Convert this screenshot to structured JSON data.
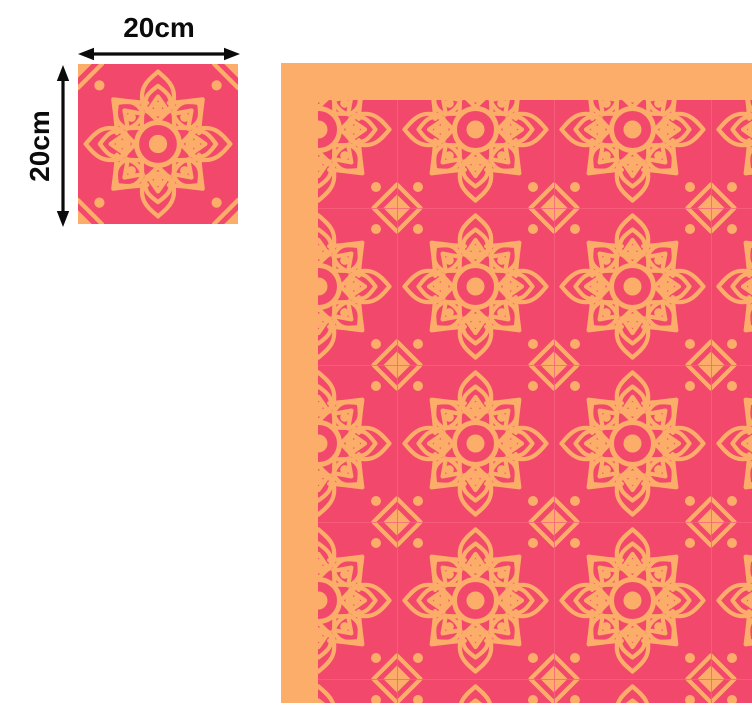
{
  "dimension_labels": {
    "width": "20cm",
    "height": "20cm"
  },
  "colors": {
    "tile_pink": "#F2486B",
    "accent_orange": "#FBAD69",
    "grout_pink": "#F7617F",
    "label_black": "#0B0B0B",
    "page_background": "#FFFFFF"
  },
  "icons": {
    "width_arrow": "double-headed-horizontal-arrow-icon",
    "height_arrow": "double-headed-vertical-arrow-icon",
    "tile_motif": "mandala-flower-tile",
    "junction_motif": "diamond-corner-motif"
  }
}
